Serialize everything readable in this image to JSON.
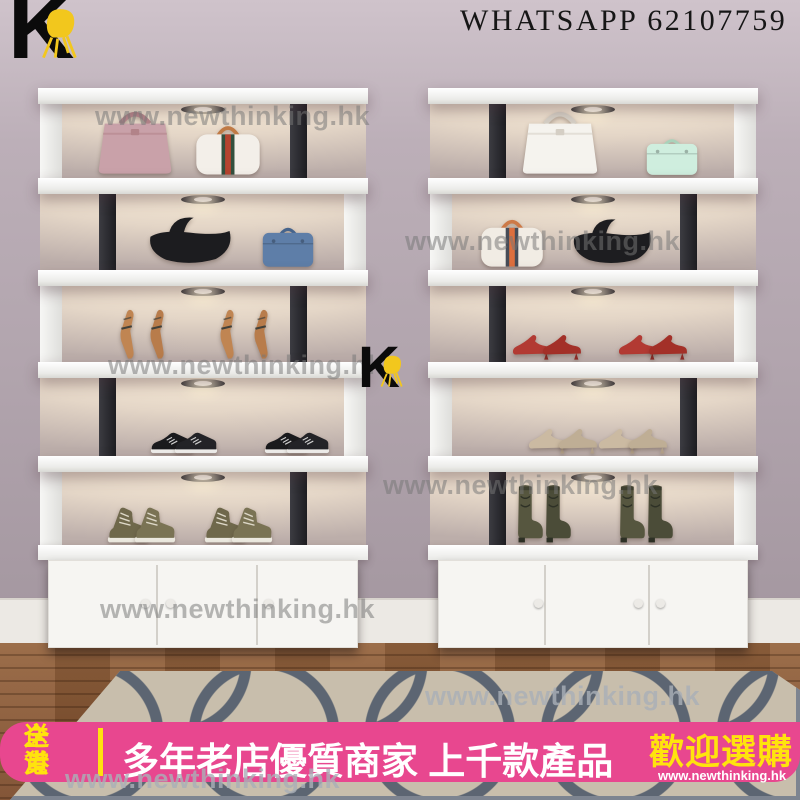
{
  "header": {
    "whatsapp_label": "WHATSAPP 62107759",
    "brand_letter": "K"
  },
  "watermark": {
    "text": "www.newthinking.hk",
    "instances": [
      {
        "x": 95,
        "y": 101,
        "light": false
      },
      {
        "x": 405,
        "y": 226,
        "light": false
      },
      {
        "x": 108,
        "y": 350,
        "light": false
      },
      {
        "x": 383,
        "y": 470,
        "light": false
      },
      {
        "x": 100,
        "y": 594,
        "light": false
      },
      {
        "x": 425,
        "y": 681,
        "light": true
      },
      {
        "x": 65,
        "y": 764,
        "light": true
      }
    ]
  },
  "brand_marks": [
    {
      "x": 8,
      "y": -10,
      "k_size": 92,
      "chair": {
        "x": 28,
        "y": 18,
        "w": 48,
        "h": 52
      }
    },
    {
      "x": 358,
      "y": 344,
      "k_size": 58,
      "chair": {
        "x": 19,
        "y": 11,
        "w": 30,
        "h": 33
      }
    }
  ],
  "scene": {
    "wall": "#b4a7b0",
    "skirting": "#ece9e4",
    "floor_wood": "#8a583a",
    "rug_base": "#c8beac",
    "rug_pattern": "#5c6572",
    "shelf_white": "#f9f9f7",
    "support_black": "#26262b",
    "chair_yellow": "#f2c71d",
    "led_glow": "#f6e9d6"
  },
  "units": [
    {
      "name": "left-display-unit",
      "x": 38,
      "compartments": [
        {
          "panel": "left",
          "items": [
            {
              "t": "birkin",
              "label": "pink-handbag",
              "x": 97,
              "w": 84,
              "h": 72,
              "c": "#c9a1a9",
              "a": "#b28389"
            },
            {
              "t": "boston",
              "label": "white-striped-handbag",
              "x": 190,
              "w": 72,
              "h": 58,
              "c": "#f3efe9",
              "a": "#c07a45",
              "s": [
                "#33503e",
                "#b5432f"
              ]
            }
          ]
        },
        {
          "panel": "right",
          "items": [
            {
              "t": "hobo",
              "label": "black-hobo-bag",
              "x": 152,
              "w": 92,
              "h": 56,
              "c": "#1c1c1f"
            },
            {
              "t": "satchel",
              "label": "blue-satchel-bag",
              "x": 250,
              "w": 60,
              "h": 46,
              "c": "#5e7ea8",
              "a": "#46648c"
            }
          ]
        },
        {
          "panel": "left",
          "items": [
            {
              "t": "pumpstand",
              "label": "tan-heel",
              "x": 90,
              "w": 22,
              "h": 52,
              "c": "#c08552",
              "d": "#42413a"
            },
            {
              "t": "pumpstand",
              "label": "tan-heel",
              "x": 120,
              "w": 22,
              "h": 52,
              "c": "#b87c4b",
              "d": "#42413a"
            },
            {
              "t": "pumpstand",
              "label": "tan-heel",
              "x": 190,
              "w": 22,
              "h": 52,
              "c": "#c08552",
              "d": "#42413a"
            },
            {
              "t": "pumpstand",
              "label": "tan-heel",
              "x": 224,
              "w": 22,
              "h": 52,
              "c": "#b87c4b",
              "d": "#42413a"
            }
          ]
        },
        {
          "panel": "right",
          "items": [
            {
              "t": "sneaker",
              "label": "black-sneaker",
              "x": 134,
              "w": 44,
              "h": 24,
              "c": "#1a1a1d"
            },
            {
              "t": "sneaker",
              "label": "black-sneaker",
              "x": 158,
              "w": 44,
              "h": 24,
              "c": "#232327"
            },
            {
              "t": "sneaker",
              "label": "black-sneaker",
              "x": 248,
              "w": 44,
              "h": 24,
              "c": "#1a1a1d"
            },
            {
              "t": "sneaker",
              "label": "black-sneaker",
              "x": 270,
              "w": 44,
              "h": 24,
              "c": "#232327"
            }
          ]
        },
        {
          "panel": "left",
          "items": [
            {
              "t": "hightop",
              "label": "khaki-hightop-sneaker",
              "x": 90,
              "w": 42,
              "h": 38,
              "c": "#6f684b"
            },
            {
              "t": "hightop",
              "label": "khaki-hightop-sneaker",
              "x": 117,
              "w": 42,
              "h": 38,
              "c": "#7a7354"
            },
            {
              "t": "hightop",
              "label": "khaki-hightop-sneaker",
              "x": 187,
              "w": 42,
              "h": 38,
              "c": "#6f684b"
            },
            {
              "t": "hightop",
              "label": "khaki-hightop-sneaker",
              "x": 214,
              "w": 42,
              "h": 38,
              "c": "#7a7354"
            }
          ]
        }
      ],
      "cabinet": {
        "dividers": [
          107,
          207
        ],
        "knobs": [
          92,
          117,
          215
        ]
      }
    },
    {
      "name": "right-display-unit",
      "x": 428,
      "compartments": [
        {
          "panel": "right",
          "items": [
            {
              "t": "birkin",
              "label": "white-handbag",
              "x": 132,
              "w": 86,
              "h": 72,
              "c": "#f5f3ee",
              "a": "#d5cfc5"
            },
            {
              "t": "satchel",
              "label": "mint-crossbody-bag",
              "x": 244,
              "w": 60,
              "h": 42,
              "c": "#cfeede",
              "a": "#a9d2ba"
            }
          ]
        },
        {
          "panel": "left",
          "items": [
            {
              "t": "boston",
              "label": "white-orange-striped-handbag",
              "x": 84,
              "w": 70,
              "h": 56,
              "c": "#f1ece4",
              "a": "#cd7a48",
              "s": [
                "#474c57",
                "#dd6f3e"
              ]
            },
            {
              "t": "hobo",
              "label": "black-hobo-bag",
              "x": 184,
              "w": 88,
              "h": 54,
              "c": "#1d1d20"
            }
          ]
        },
        {
          "panel": "right",
          "items": [
            {
              "t": "pump",
              "label": "red-heel",
              "x": 104,
              "w": 42,
              "h": 27,
              "c": "#b23a33",
              "d": "#8c2b26"
            },
            {
              "t": "pump",
              "label": "red-heel",
              "x": 134,
              "w": 42,
              "h": 27,
              "c": "#a33028",
              "d": "#8c2b26"
            },
            {
              "t": "pump",
              "label": "red-heel",
              "x": 210,
              "w": 42,
              "h": 27,
              "c": "#b23a33",
              "d": "#8c2b26"
            },
            {
              "t": "pump",
              "label": "red-heel",
              "x": 240,
              "w": 42,
              "h": 27,
              "c": "#a33028",
              "d": "#8c2b26"
            }
          ]
        },
        {
          "panel": "left",
          "items": [
            {
              "t": "pump",
              "label": "champagne-heel",
              "x": 120,
              "w": 42,
              "h": 27,
              "c": "#cbbaa2",
              "d": "#b3a28a"
            },
            {
              "t": "pump",
              "label": "champagne-heel",
              "x": 150,
              "w": 42,
              "h": 27,
              "c": "#bfae95",
              "d": "#b3a28a"
            },
            {
              "t": "pump",
              "label": "champagne-heel",
              "x": 190,
              "w": 42,
              "h": 27,
              "c": "#cbbaa2",
              "d": "#b3a28a"
            },
            {
              "t": "pump",
              "label": "champagne-heel",
              "x": 220,
              "w": 42,
              "h": 27,
              "c": "#bfae95",
              "d": "#b3a28a"
            }
          ]
        },
        {
          "panel": "right",
          "items": [
            {
              "t": "cowboy",
              "label": "olive-cowboy-boot",
              "x": 102,
              "w": 34,
              "h": 60,
              "c": "#56563f",
              "d": "#2e3126"
            },
            {
              "t": "cowboy",
              "label": "olive-cowboy-boot",
              "x": 130,
              "w": 34,
              "h": 60,
              "c": "#4b4c38",
              "d": "#2e3126"
            },
            {
              "t": "cowboy",
              "label": "olive-cowboy-boot",
              "x": 204,
              "w": 34,
              "h": 60,
              "c": "#56563f",
              "d": "#2e3126"
            },
            {
              "t": "cowboy",
              "label": "olive-cowboy-boot",
              "x": 232,
              "w": 34,
              "h": 60,
              "c": "#4b4c38",
              "d": "#2e3126"
            }
          ]
        }
      ],
      "cabinet": {
        "dividers": [
          105,
          209
        ],
        "knobs": [
          95,
          195,
          217
        ]
      }
    }
  ],
  "banner": {
    "bg": "#e8478f",
    "accent_yellow": "#ffe30d",
    "delivery_line1": "全港",
    "delivery_line2": "送貨",
    "headline": "多年老店優質商家 上千款產品",
    "cta": "歡迎選購",
    "site_url": "www.newthinking.hk"
  }
}
